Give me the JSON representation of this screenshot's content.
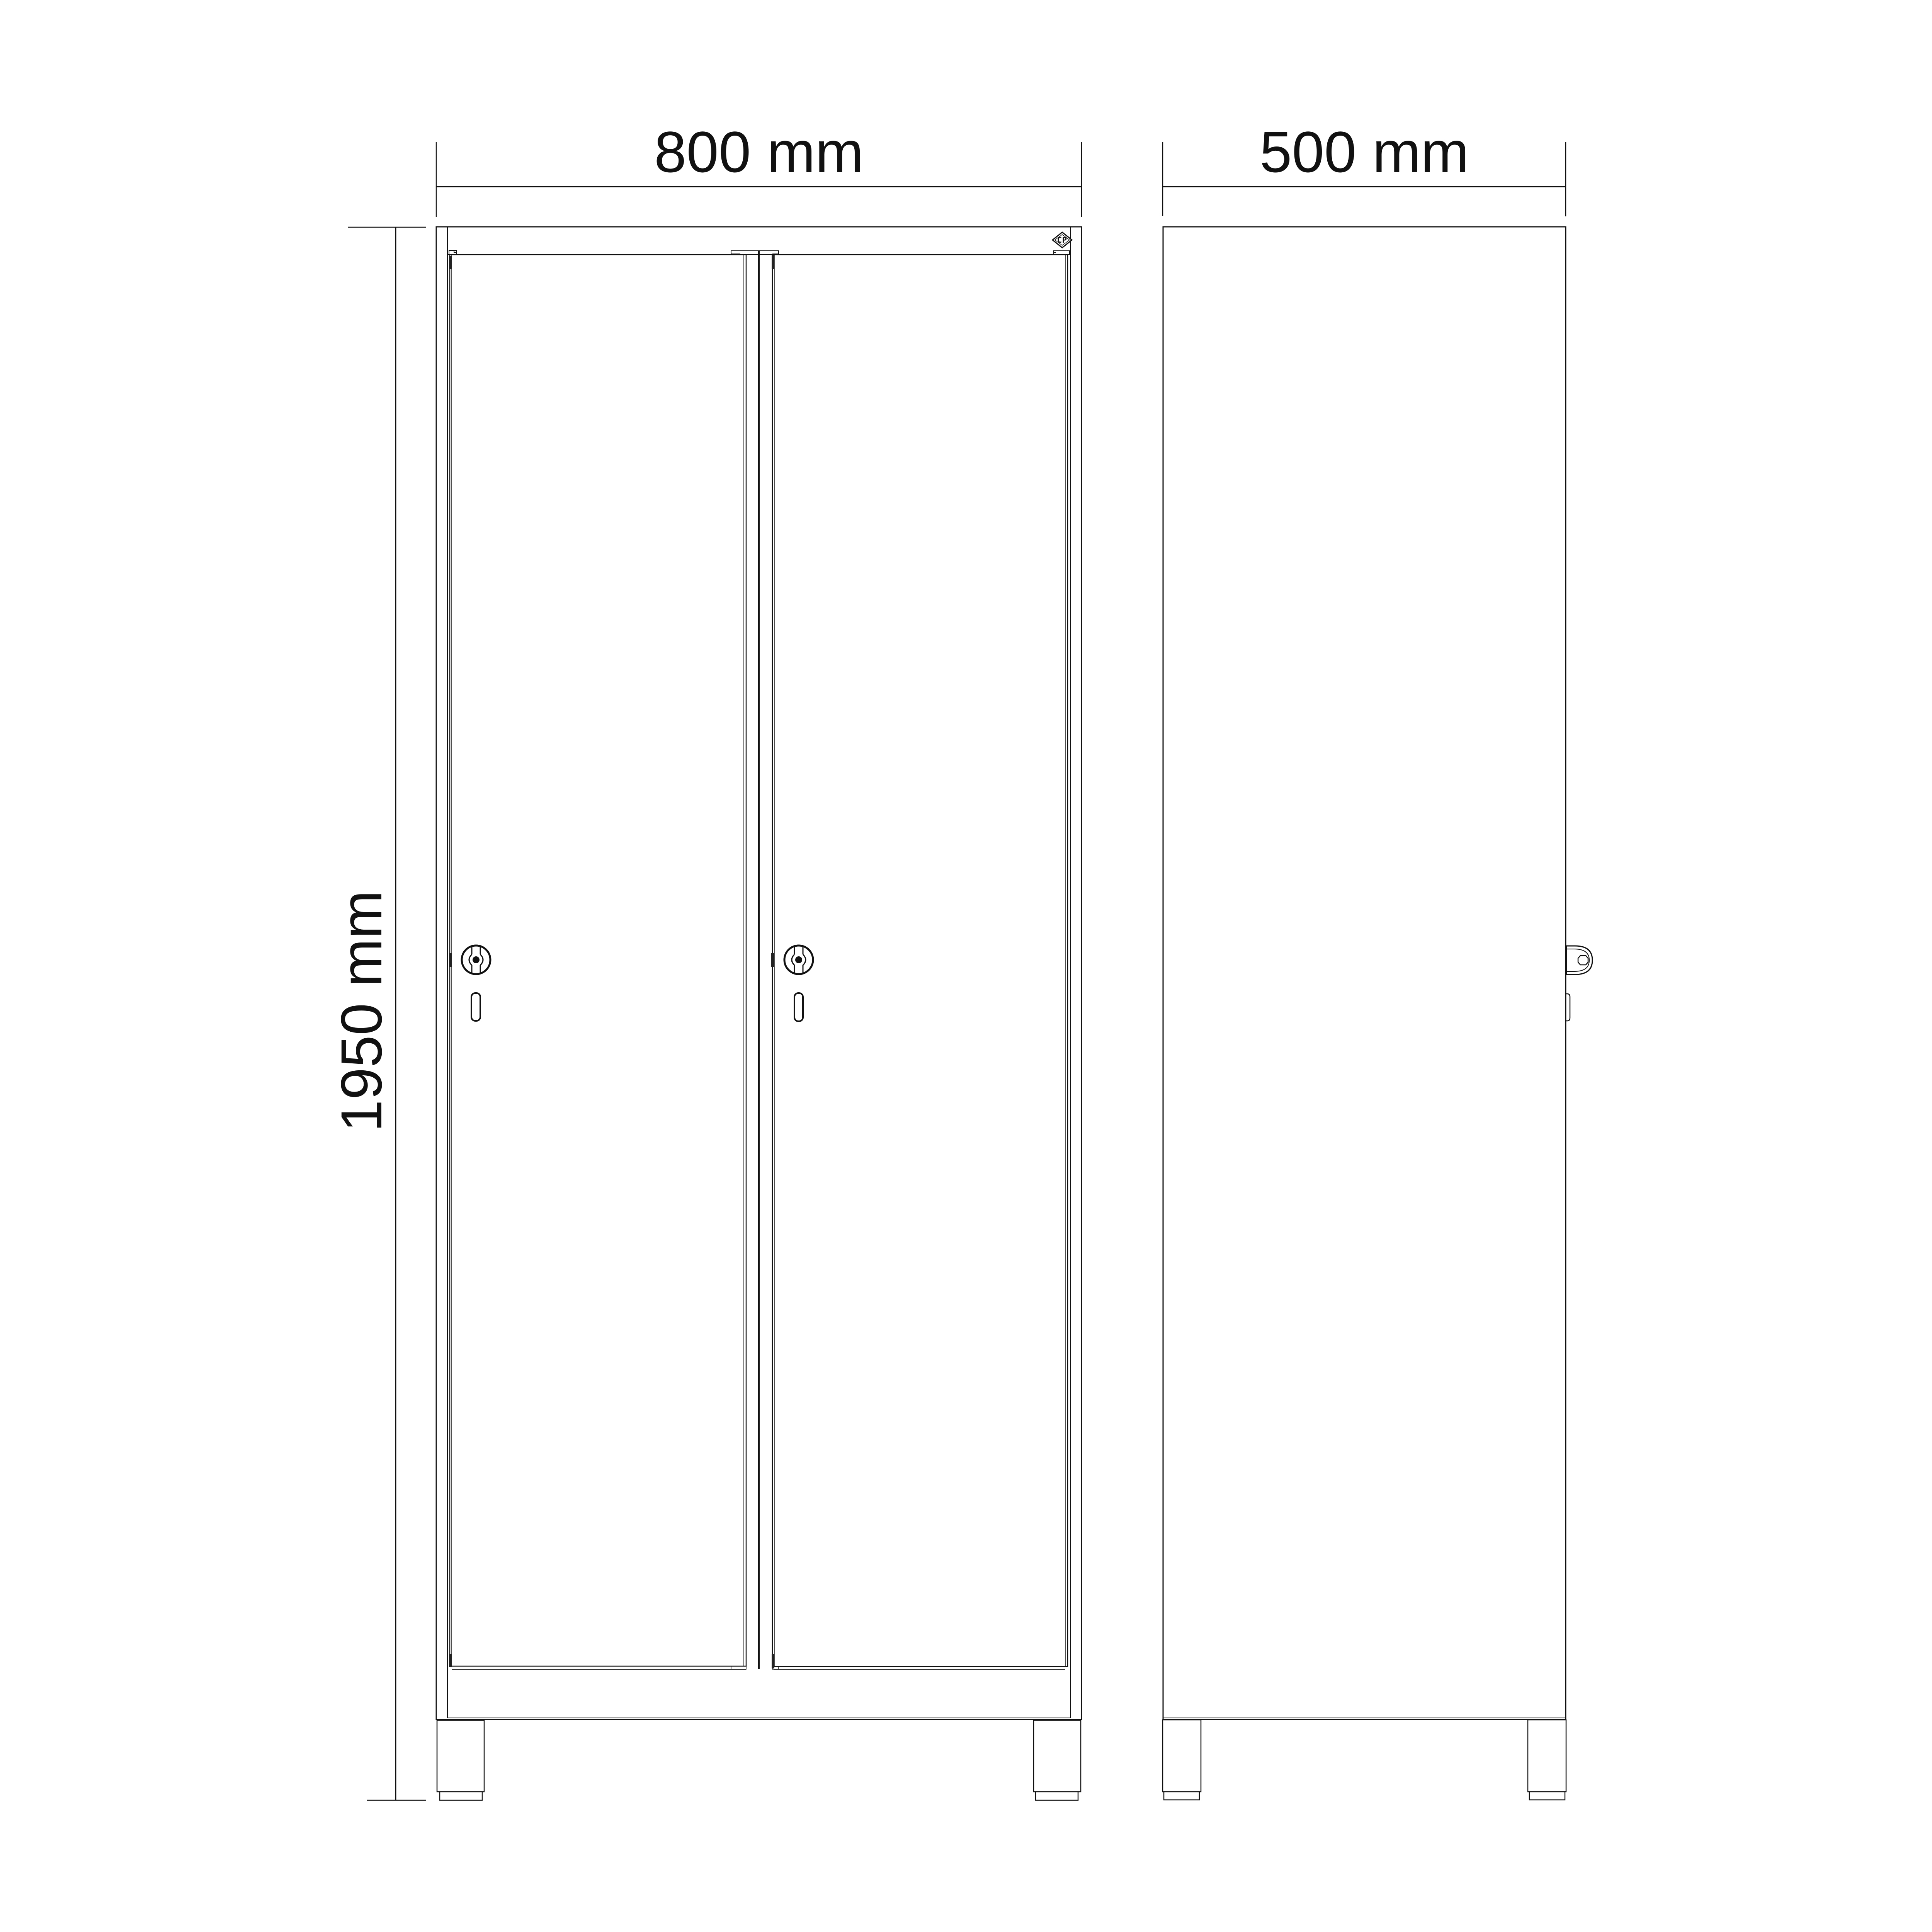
{
  "page": {
    "background": "#ffffff",
    "line_color": "#111111",
    "description": "Technical drawing of a two-door locker cabinet, front and side elevation views with overall dimensions"
  },
  "dimensions": {
    "width": {
      "label": "800 mm",
      "value": 800,
      "unit": "mm",
      "applies_to": "front view overall width"
    },
    "depth": {
      "label": "500 mm",
      "value": 500,
      "unit": "mm",
      "applies_to": "side view overall depth"
    },
    "height": {
      "label": "1950 mm",
      "value": 1950,
      "unit": "mm",
      "applies_to": "overall height including feet"
    }
  },
  "logo": {
    "text": "CP"
  },
  "icons": {
    "cam_lock": "cam-lock-icon",
    "key_slot": "key-slot-icon",
    "logo_diamond": "diamond-logo-icon"
  }
}
